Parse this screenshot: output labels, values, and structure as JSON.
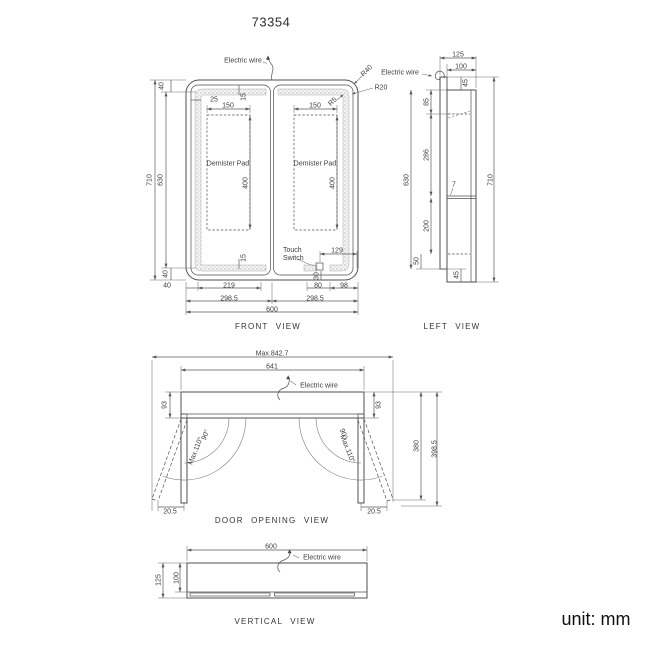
{
  "title": "73354",
  "unit_label": "unit: mm",
  "front_view": {
    "label": "FRONT VIEW",
    "annotations": {
      "electric_wire": "Electric wire",
      "touch_switch": "Touch Switch",
      "demister_left": "Demister Pad",
      "demister_right": "Demister Pad"
    },
    "dims": {
      "top_margin": "40",
      "overall_height": "710",
      "door_height": "630",
      "bottom_margin": "40",
      "inset_h": "25",
      "inset_v_top": "15",
      "pad_width_left": "150",
      "pad_width_right": "150",
      "pad_height_left": "400",
      "pad_height_right": "400",
      "inset_v_bottom": "15",
      "switch_offset": "129",
      "switch_bottom": "30",
      "bottom_a": "40",
      "bottom_b": "219",
      "bottom_c": "80",
      "bottom_d": "98",
      "half_left": "298.5",
      "half_right": "298.5",
      "overall_width": "600",
      "r_outer": "R40",
      "r_mid": "R20",
      "r_inner": "R5"
    }
  },
  "left_view": {
    "label": "LEFT VIEW",
    "annotations": {
      "electric_wire": "Electric wire"
    },
    "dims": {
      "depth_overall": "125",
      "depth_body": "100",
      "top_offset": "45",
      "seg_top": "85",
      "seg_upper": "286",
      "shelf_thickness": "7",
      "seg_lower": "200",
      "seg_bottom": "50",
      "body_height": "630",
      "overall_height": "710",
      "bottom_offset": "45"
    }
  },
  "door_opening_view": {
    "label": "DOOR OPENING VIEW",
    "annotations": {
      "electric_wire": "Electric wire"
    },
    "dims": {
      "max_width": "Max.842.7",
      "body_width": "641",
      "depth_left": "93",
      "depth_right": "93",
      "angle_left": "90°",
      "angle_left_max": "Max.110°",
      "angle_right": "90°",
      "angle_right_max": "Max.110°",
      "offset_left": "20.5",
      "offset_right": "20.5",
      "reach": "380",
      "reach_max": "398.5"
    }
  },
  "vertical_view": {
    "label": "VERTICAL VIEW",
    "annotations": {
      "electric_wire": "Electric wire"
    },
    "dims": {
      "width": "600",
      "depth_body": "100",
      "depth_overall": "125"
    }
  }
}
